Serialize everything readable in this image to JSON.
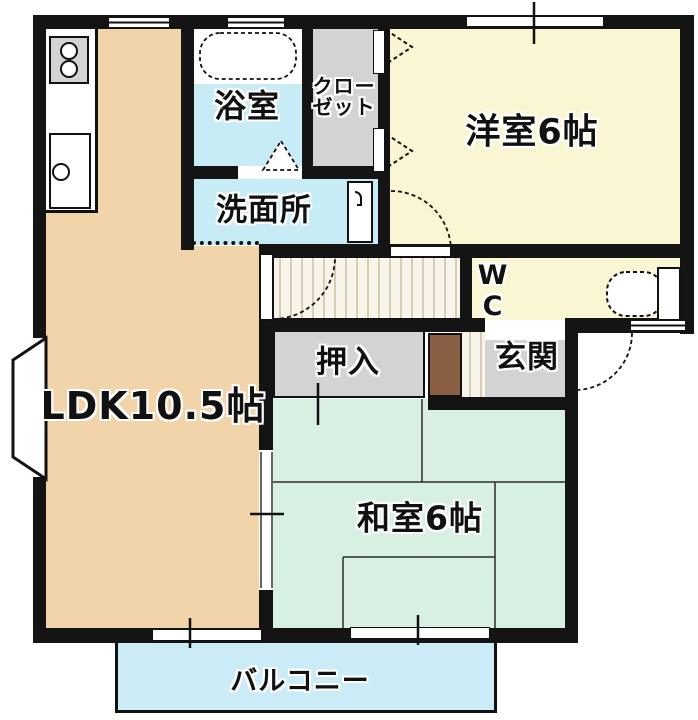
{
  "plan": {
    "type": "apartment-floor-plan",
    "labels": {
      "ldk": "LDK10.5帖",
      "western_room": "洋室6帖",
      "japanese_room": "和室6帖",
      "bath": "浴室",
      "washroom": "洗面所",
      "closet_line1": "クロー",
      "closet_line2": "ゼット",
      "oshiire": "押入",
      "entrance": "玄関",
      "wc_line1": "W",
      "wc_line2": "C",
      "balcony": "バルコニー"
    },
    "colors": {
      "wall": "#141414",
      "ldk_floor": "#f1d4a9",
      "wet_area_floor": "#c8ecf6",
      "western_room_floor": "#faf6d4",
      "japanese_room_floor": "#d8f0e1",
      "balcony_floor": "#cbebf7",
      "storage_floor": "#d3d3d3",
      "shoe_cabinet": "#8a5f43",
      "hallway_floor": "#f8f4ea"
    },
    "fixtures": [
      "bathtub",
      "stove-2-burner",
      "kitchen-sink",
      "toilet",
      "washing-machine-space",
      "bay-window",
      "tatami-6-mats"
    ]
  }
}
